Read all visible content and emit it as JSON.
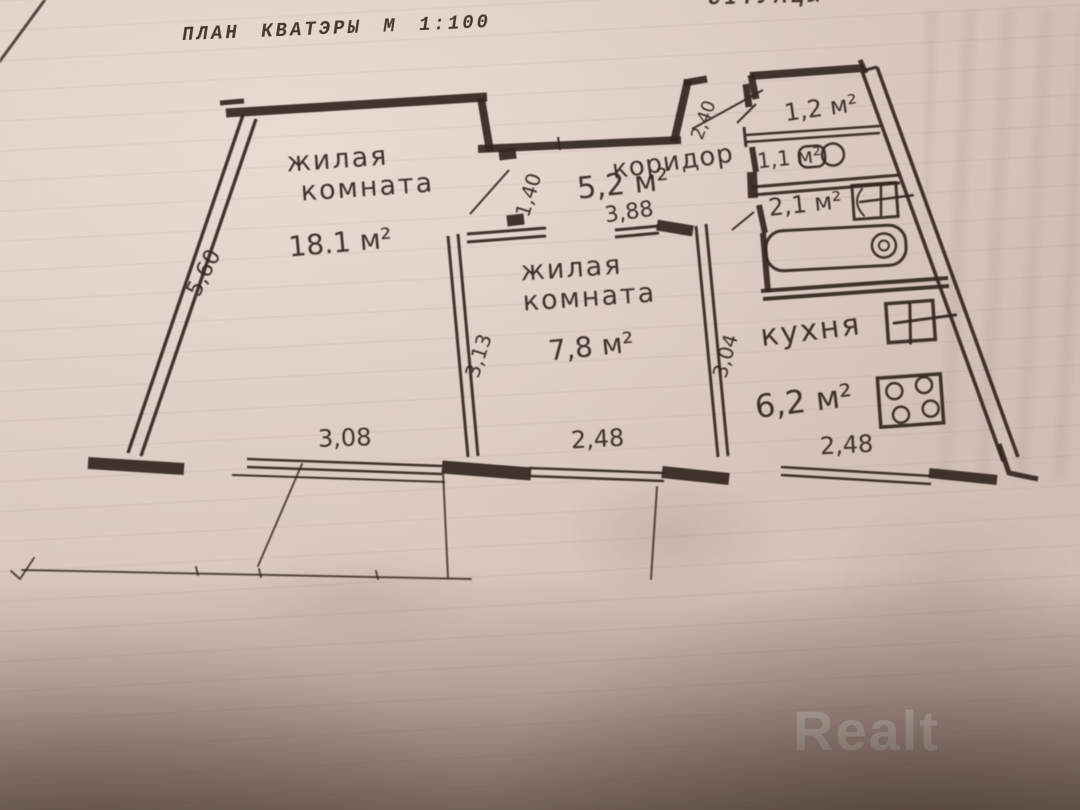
{
  "photo": {
    "title": "ПЛАН КВАТЭРЫ М 1:100",
    "corner_text": "СІТУАЦЫ",
    "watermark": "Realt"
  },
  "rooms": {
    "living1": {
      "name_line1": "жилая",
      "name_line2": "комната",
      "area": "18.1 м²"
    },
    "living2": {
      "name_line1": "жилая",
      "name_line2": "комната",
      "area": "7,8 м²"
    },
    "corridor": {
      "name": "коридор",
      "area": "5,2 м²"
    },
    "kitchen": {
      "name": "кухня",
      "area": "6,2 м²"
    },
    "closet": {
      "area": "1,2 м²"
    },
    "wc": {
      "area": "1,1 м²"
    },
    "bath": {
      "area": "2,1 м²"
    }
  },
  "dimensions": {
    "left_wall": "5,60",
    "living1_window": "3,08",
    "living2_window": "2,48",
    "kitchen_window": "2,48",
    "living1_door": "1,40",
    "corridor_length": "3,88",
    "living2_side": "3,13",
    "kitchen_side": "3,04",
    "entrance": "2,40"
  },
  "colors": {
    "ink": "#33261e",
    "paper": "#d9c7be",
    "watermark_text": "rgba(255,255,255,0.78)"
  }
}
